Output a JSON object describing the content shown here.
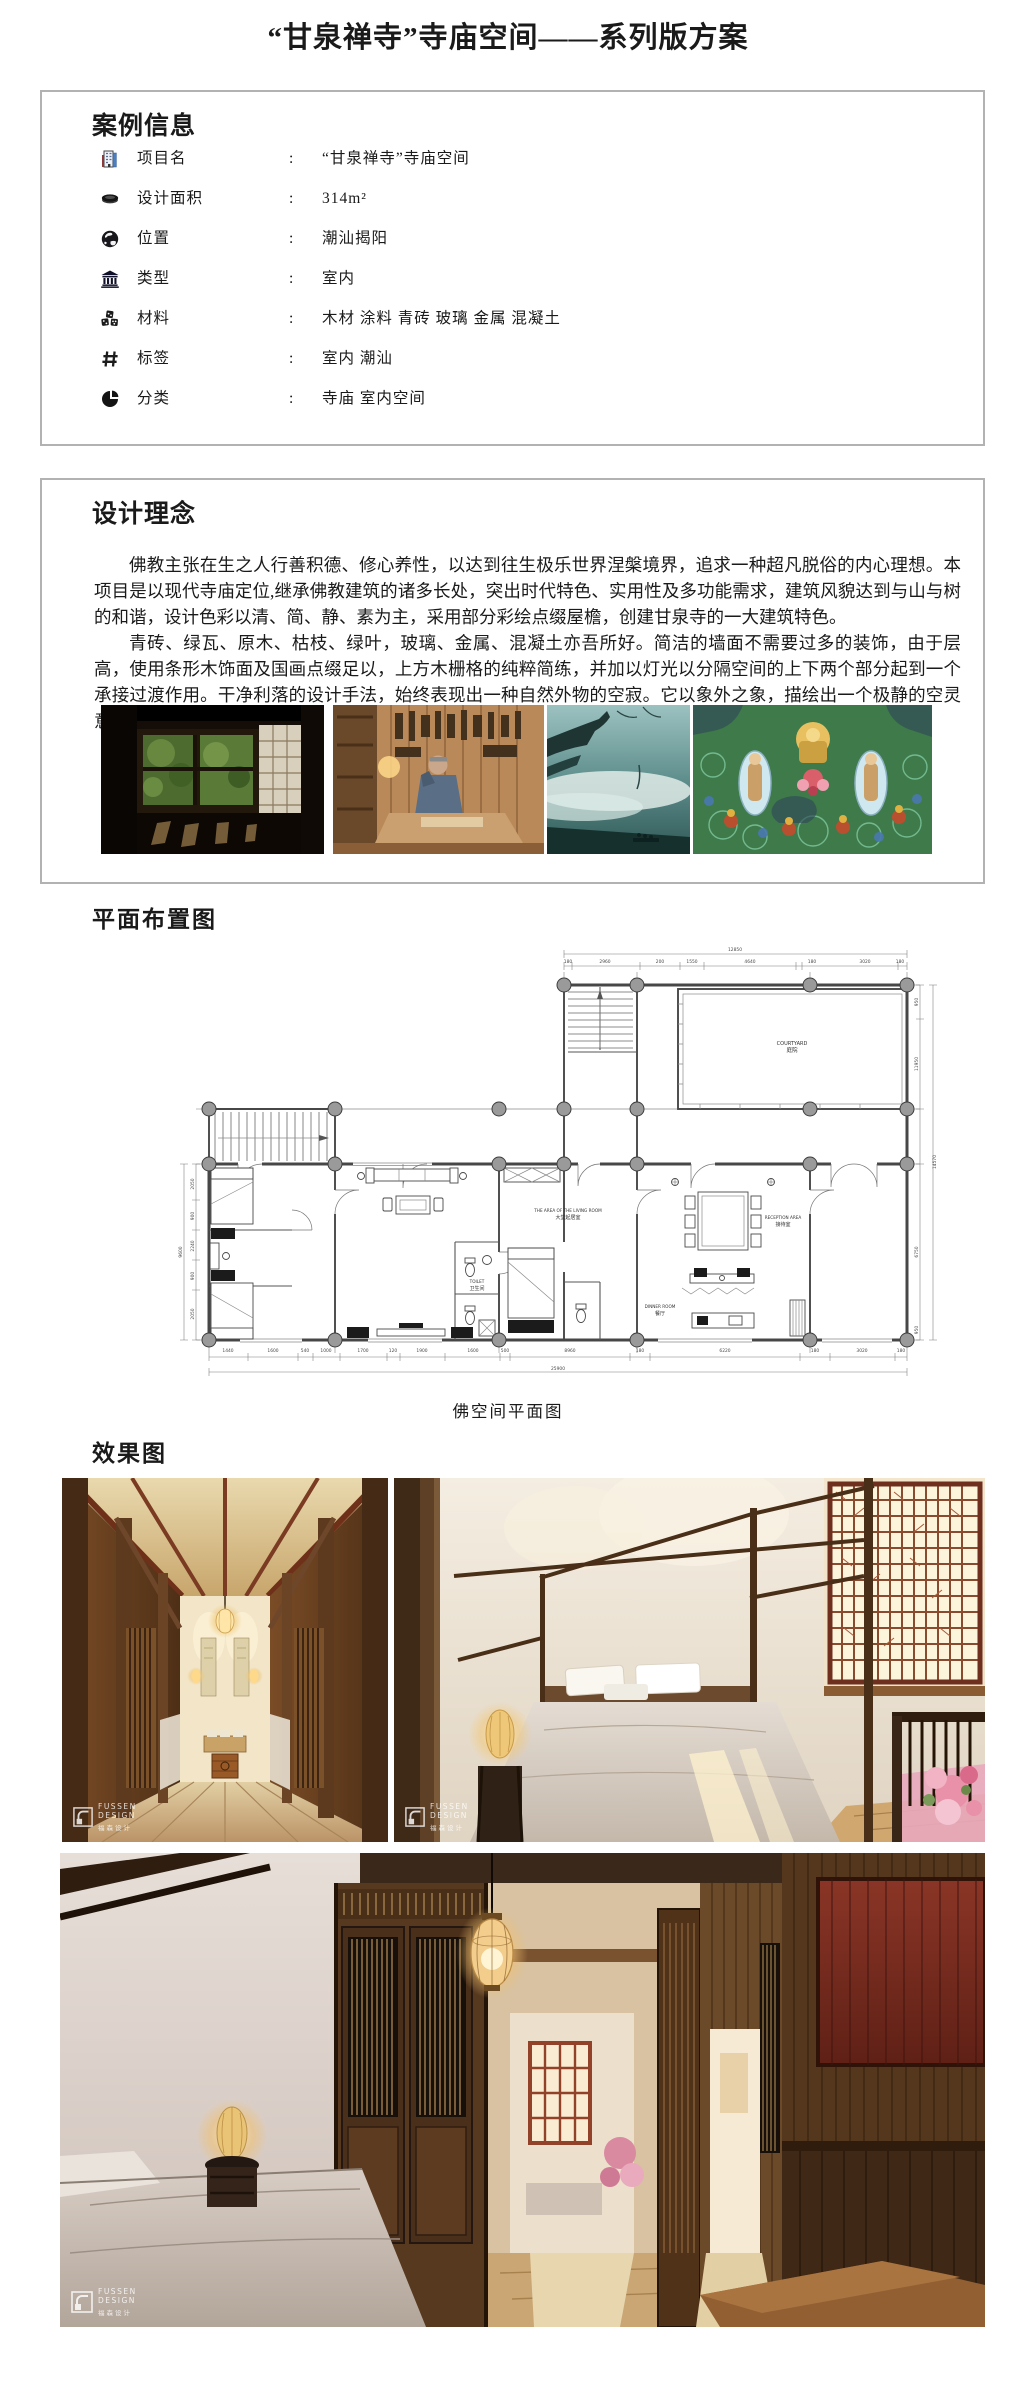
{
  "page_title": "“甘泉禅寺”寺庙空间——系列版方案",
  "case_info": {
    "heading": "案例信息",
    "separator": ":",
    "rows": [
      {
        "icon": "building-icon",
        "label": "项目名",
        "value": "“甘泉禅寺”寺庙空间"
      },
      {
        "icon": "area-icon",
        "label": "设计面积",
        "value": "314m²"
      },
      {
        "icon": "globe-icon",
        "label": "位置",
        "value": "潮汕揭阳"
      },
      {
        "icon": "temple-icon",
        "label": "类型",
        "value": "室内"
      },
      {
        "icon": "materials-icon",
        "label": "材料",
        "value": "木材 涂料 青砖 玻璃 金属 混凝土"
      },
      {
        "icon": "tag-icon",
        "label": "标签",
        "value": "室内 潮汕"
      },
      {
        "icon": "category-icon",
        "label": "分类",
        "value": "寺庙 室内空间"
      }
    ]
  },
  "design_concept": {
    "heading": "设计理念",
    "paragraph_1": "佛教主张在生之人行善积德、修心养性，以达到往生极乐世界涅槃境界，追求一种超凡脱俗的内心理想。本项目是以现代寺庙定位,继承佛教建筑的诸多长处，突出时代特色、实用性及多功能需求，建筑风貌达到与山与树的和谐，设计色彩以清、简、静、素为主，采用部分彩绘点缀屋檐，创建甘泉寺的一大建筑特色。",
    "paragraph_2": "青砖、绿瓦、原木、枯枝、绿叶，玻璃、金属、混凝土亦吾所好。简洁的墙面不需要过多的装饰，由于层高，使用条形木饰面及国画点缀足以，上方木栅格的纯粹简练，并加以灯光以分隔空间的上下两个部分起到一个承接过渡作用。干净利落的设计手法，始终表现出一种自然外物的空寂。它以象外之象，描绘出一个极静的空灵意境。",
    "reference_photos": [
      "dark-room-garden-window",
      "wood-workshop-craftsman",
      "temple-eave-in-mist",
      "thangka-mural"
    ]
  },
  "floor_plan": {
    "heading": "平面布置图",
    "caption": "佛空间平面图",
    "labels": {
      "courtyard_en": "COURTYARD",
      "courtyard_cn": "庭院",
      "living_en": "THE AREA OF THE LIVING ROOM",
      "living_cn": "大堂起居室",
      "reception_en": "RECEPTION AREA",
      "reception_cn": "接待室",
      "toilet_en": "TOILET",
      "toilet_cn": "卫生间",
      "dinner_en": "DINNER ROOM",
      "dinner_cn": "餐厅"
    },
    "dimensions": {
      "top_total": "12850",
      "top": [
        "180",
        "2960",
        "200",
        "1550",
        "4640",
        "180",
        "3020",
        "180"
      ],
      "bottom": [
        "1440",
        "1600",
        "540",
        "1000",
        "1700",
        "120",
        "1900",
        "1600",
        "500",
        "8960",
        "180",
        "6220",
        "180",
        "3020",
        "180"
      ],
      "bottom_total": "25900",
      "right": [
        "950",
        "11950",
        "6750",
        "950"
      ],
      "right_total": "14570",
      "left": [
        "2050",
        "900",
        "2240",
        "900",
        "2050"
      ],
      "left_total": "9600"
    }
  },
  "renders": {
    "heading": "效果图",
    "watermark": {
      "en_1": "FUSSEN",
      "en_2": "DESIGN",
      "cn": "福森设计"
    }
  }
}
